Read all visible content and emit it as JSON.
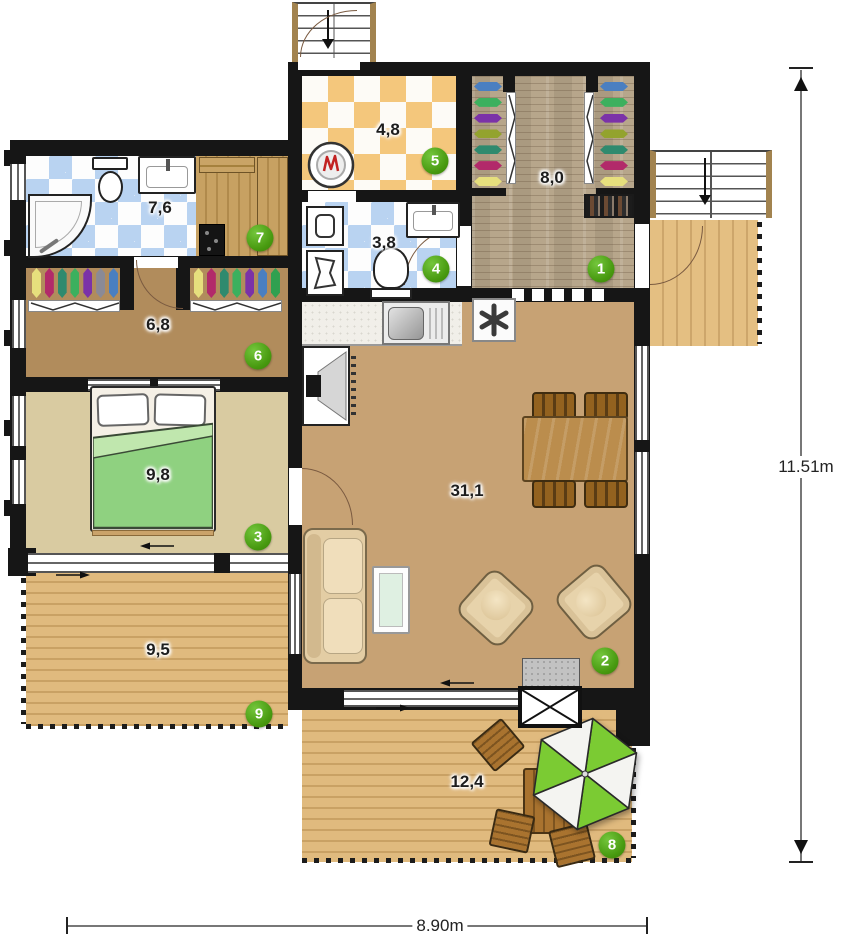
{
  "plan": {
    "type": "floor-plan"
  },
  "dimensions": {
    "height_label": "11.51m",
    "width_label": "8.90m"
  },
  "rooms": [
    {
      "badge": "1",
      "area": "8,0"
    },
    {
      "badge": "2",
      "area": "31,1"
    },
    {
      "badge": "3",
      "area": "9,8"
    },
    {
      "badge": "4",
      "area": "3,8"
    },
    {
      "badge": "5",
      "area": "4,8"
    },
    {
      "badge": "6",
      "area": "6,8"
    },
    {
      "badge": "7",
      "area": "7,6"
    },
    {
      "badge": "8",
      "area": "12,4"
    },
    {
      "badge": "9",
      "area": "9,5"
    }
  ],
  "colors": {
    "wall": "#161616",
    "badge_green": "#47990f",
    "umbrella_green": "#7bcb33",
    "living_floor": "#c7a274",
    "bedroom_floor": "#d9cba1",
    "hall_floor": "#b18c5c",
    "terrace_wood": "#e0ba7e",
    "tile_blue": "#b9d3f1",
    "tile_orange": "#f4c77c"
  }
}
